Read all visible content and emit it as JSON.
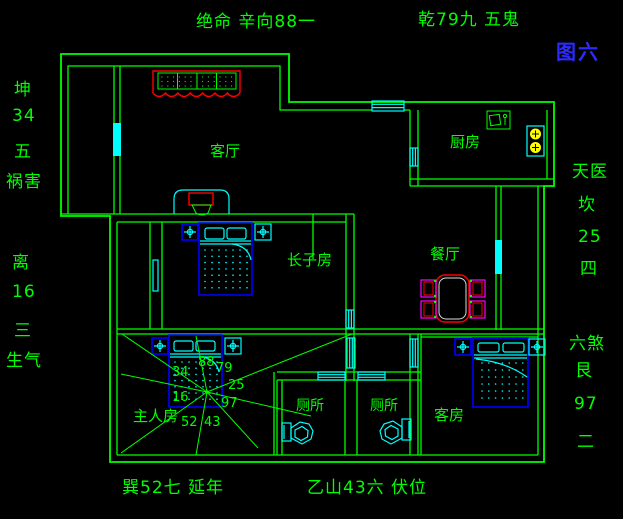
{
  "figure": {
    "label": "图六"
  },
  "annotations": {
    "top_left": "绝命 辛向88一",
    "top_right": "乾79九 五鬼",
    "bottom_left": "巽52七 延年",
    "bottom_right": "乙山43六 伏位",
    "left_column": [
      "坤",
      "34",
      "五",
      "祸害",
      "离",
      "16",
      "三",
      "生气"
    ],
    "right_column": [
      "天医",
      "坎",
      "25",
      "四",
      "六煞",
      "艮",
      "97",
      "二"
    ]
  },
  "rooms": {
    "living": "客厅",
    "kitchen": "厨房",
    "eldest_son": "长子房",
    "dining": "餐厅",
    "master": "主人房",
    "toilet_left": "厕所",
    "toilet_right": "厕所",
    "guest": "客房"
  },
  "master_chart": {
    "n": "88",
    "ne": "79",
    "e": "25",
    "se": "97",
    "s": "43",
    "sw": "52",
    "w": "16",
    "nw": "34"
  },
  "colors": {
    "green": "#00ff00",
    "cyan": "#00ffff",
    "blue": "#0000ff",
    "red": "#ff0000",
    "magenta": "#ff00ff",
    "yellow": "#ffff00",
    "figblue": "#2b2bff",
    "bg": "#000000"
  }
}
